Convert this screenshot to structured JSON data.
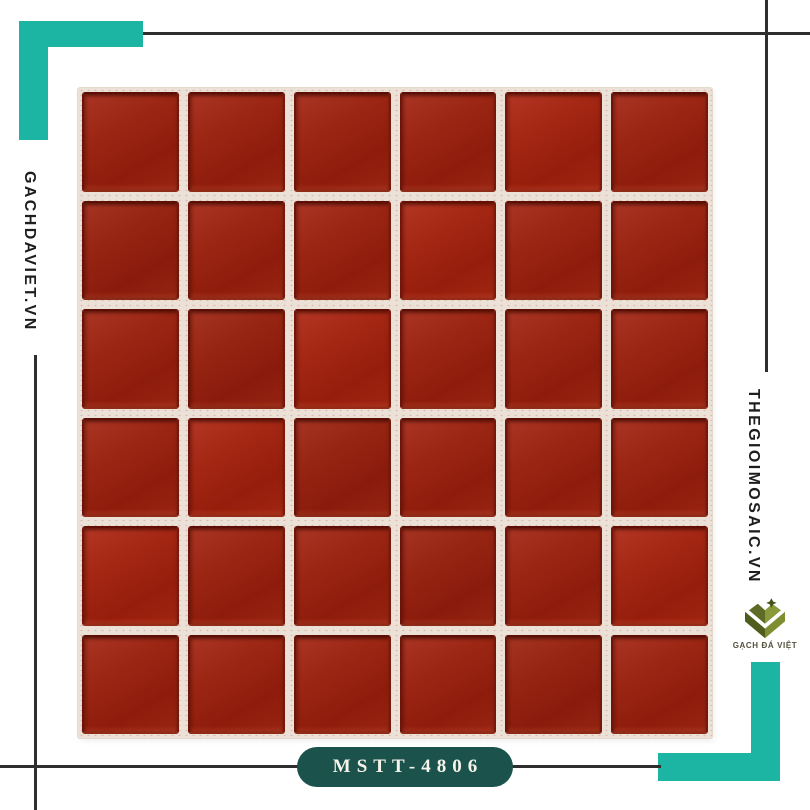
{
  "page": {
    "background": "#ffffff"
  },
  "colors": {
    "page_bg": "#ffffff",
    "accent_teal": "#1cb5a3",
    "badge_teal": "#1b524b",
    "line_dark": "#2e2e2e",
    "text_dark": "#1e1e1e",
    "grout": "#ece1d7",
    "tile_red": "#9c2614",
    "tile_red_dark": "#7a170b",
    "tile_red_light": "#aa3524",
    "logo_olive_dark": "#4e5c1d",
    "logo_olive_light": "#8a9a3b"
  },
  "watermarks": {
    "left_site": "GACHDAVIET.VN",
    "right_site": "THEGIOIMOSAIC.VN"
  },
  "badge": {
    "product_code": "MSTT-4806"
  },
  "logo": {
    "name": "GẠCH ĐÁ VIỆT",
    "icon": "layered-chevron-emblem-with-star"
  },
  "mosaic": {
    "rows": 6,
    "cols": 6,
    "tile_color_name": "red glass"
  }
}
